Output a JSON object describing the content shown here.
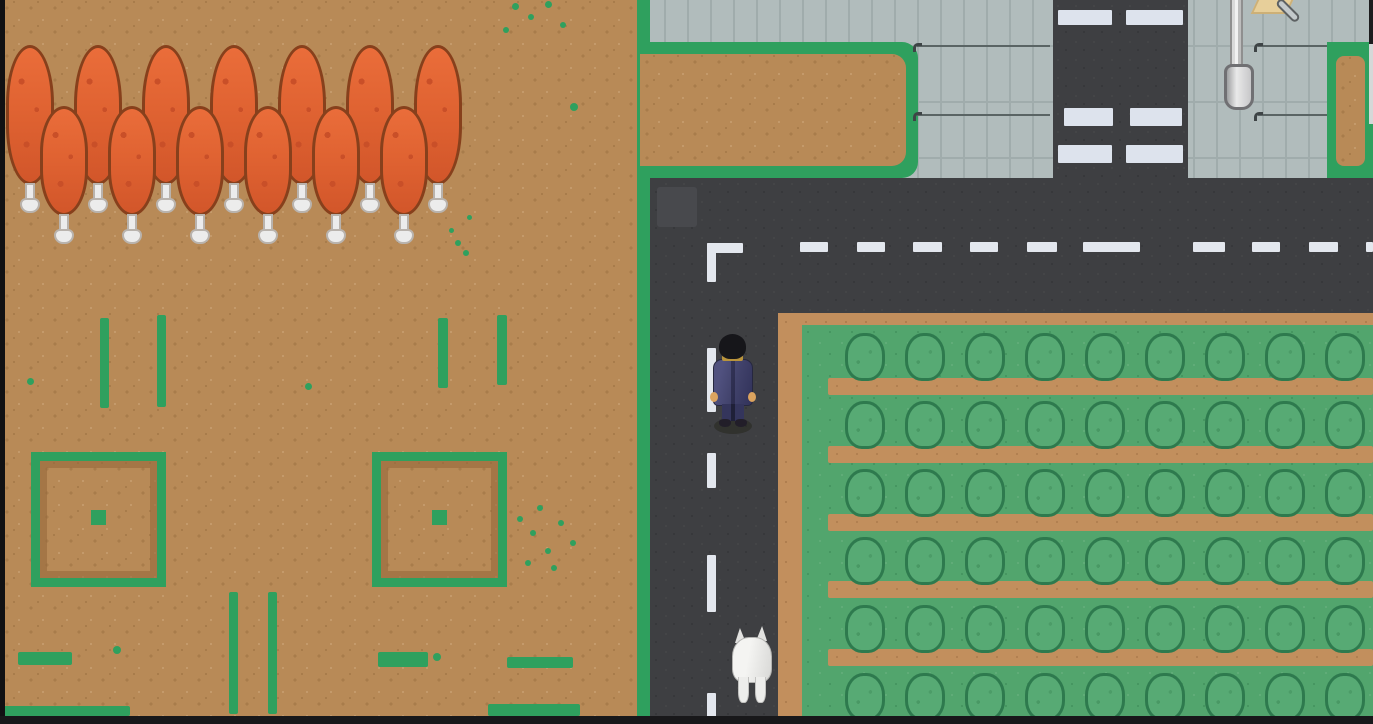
{
  "scene": {
    "type": "top-down pixel-art overworld game map",
    "visible_text": "none"
  },
  "palette": {
    "dirt": "#b88a57",
    "dirt_dot_dark": "#a87c4b",
    "dirt_dot_light": "#c49a6b",
    "grass_green": "#2fa05e",
    "farm_grass": "#52a56d",
    "farm_dirt": "#c28f5d",
    "bush_fill": "#57aa74",
    "bush_outline": "#2e7a4e",
    "road": "#3e3f42",
    "road_patch": "#48494d",
    "road_line": "#e3e7ee",
    "pavement": "#b1bcbc",
    "pavement_line": "#a0acac",
    "pavement_dark_line": "#5a6464",
    "crosswalk_white": "#dde3ed",
    "tree_canopy": "#e06332",
    "tree_canopy_dark": "#c94f28",
    "tree_outline": "#87401c",
    "tree_trunk": "#ececec",
    "player_suit": "#41426b",
    "player_hair": "#16161a",
    "player_skin": "#dca45f",
    "dog_white": "#e9e9e7",
    "sign_tan": "#e7cf9a",
    "edge_black": "#111113"
  },
  "entities": {
    "player": {
      "label": "player character in navy suit, facing away",
      "x": 711,
      "y": 334
    },
    "dog": {
      "label": "white dog, facing away",
      "x": 730,
      "y": 626
    },
    "lamp_post": {
      "x": 1224,
      "y": 0
    },
    "sign": {
      "x": 1254,
      "y": 0
    },
    "shovel": {
      "x": 1274,
      "y": 6
    }
  },
  "trees": {
    "back_row": [
      6,
      74,
      142,
      210,
      278,
      346,
      414
    ],
    "front_row": [
      40,
      108,
      176,
      244,
      312,
      380
    ],
    "back_top": 45,
    "front_top": 106,
    "back_h": 140,
    "front_h": 110
  },
  "plots": [
    {
      "x": 31,
      "y": 452,
      "size": 135
    },
    {
      "x": 372,
      "y": 452,
      "size": 135
    }
  ],
  "farm": {
    "bush_cols": [
      845,
      905,
      965,
      1025,
      1085,
      1145,
      1205,
      1265,
      1325
    ],
    "bush_rows": [
      333,
      401,
      469,
      537,
      605,
      673
    ],
    "strip_rows": [
      378,
      446,
      514,
      581,
      649
    ],
    "bush_w": 40,
    "bush_h": 48,
    "strip_h": 17,
    "strip_x": 828
  },
  "road": {
    "h_dash_y": 242,
    "h_dashes": [
      [
        800,
        28
      ],
      [
        857,
        28
      ],
      [
        913,
        29
      ],
      [
        970,
        28
      ],
      [
        1027,
        30
      ],
      [
        1083,
        57
      ],
      [
        1193,
        32
      ],
      [
        1252,
        28
      ],
      [
        1309,
        29
      ],
      [
        1366,
        7
      ]
    ],
    "v_dash_x": 707,
    "v_dashes": [
      [
        348,
        64
      ],
      [
        453,
        35
      ],
      [
        555,
        57
      ],
      [
        693,
        31
      ]
    ],
    "corner": {
      "x": 707,
      "y": 243,
      "h_w": 36,
      "h_h": 10,
      "v_w": 9,
      "v_h": 39
    }
  },
  "crosswalk": {
    "x": 1053,
    "w": 135,
    "bands": [
      {
        "y": 10,
        "h": 15,
        "segs": [
          [
            1058,
            54
          ],
          [
            1126,
            57
          ]
        ]
      },
      {
        "y": 108,
        "h": 18,
        "segs": [
          [
            1064,
            49
          ],
          [
            1130,
            52
          ]
        ]
      },
      {
        "y": 145,
        "h": 18,
        "segs": [
          [
            1058,
            54
          ],
          [
            1126,
            57
          ]
        ]
      }
    ]
  },
  "pavement_lines": [
    {
      "x": 917,
      "y": 45,
      "w": 133
    },
    {
      "x": 917,
      "y": 114,
      "w": 133
    },
    {
      "x": 1258,
      "y": 45,
      "w": 69
    },
    {
      "x": 1258,
      "y": 114,
      "w": 69
    }
  ],
  "hooks": [
    [
      913,
      43
    ],
    [
      913,
      112
    ],
    [
      1254,
      43
    ],
    [
      1254,
      112
    ]
  ],
  "decor": {
    "v_marks": [
      [
        100,
        318,
        9,
        90
      ],
      [
        157,
        315,
        9,
        92
      ],
      [
        438,
        318,
        10,
        70
      ],
      [
        497,
        315,
        10,
        70
      ],
      [
        229,
        592,
        9,
        122
      ],
      [
        268,
        592,
        9,
        122
      ]
    ],
    "h_marks": [
      [
        18,
        652,
        54,
        13
      ],
      [
        378,
        652,
        50,
        15
      ],
      [
        488,
        704,
        92,
        12
      ],
      [
        0,
        706,
        130,
        10
      ],
      [
        507,
        657,
        66,
        11
      ]
    ],
    "dots": [
      [
        27,
        378,
        7
      ],
      [
        305,
        383,
        7
      ],
      [
        570,
        103,
        8
      ],
      [
        512,
        3,
        7
      ],
      [
        528,
        14,
        6
      ],
      [
        545,
        1,
        7
      ],
      [
        560,
        22,
        6
      ],
      [
        503,
        27,
        6
      ],
      [
        455,
        240,
        6
      ],
      [
        463,
        250,
        6
      ],
      [
        449,
        228,
        5
      ],
      [
        467,
        215,
        5
      ],
      [
        517,
        516,
        6
      ],
      [
        530,
        530,
        6
      ],
      [
        545,
        548,
        6
      ],
      [
        558,
        520,
        6
      ],
      [
        570,
        540,
        6
      ],
      [
        525,
        560,
        6
      ],
      [
        551,
        565,
        6
      ],
      [
        537,
        505,
        6
      ],
      [
        433,
        653,
        8
      ],
      [
        113,
        646,
        8
      ]
    ]
  }
}
